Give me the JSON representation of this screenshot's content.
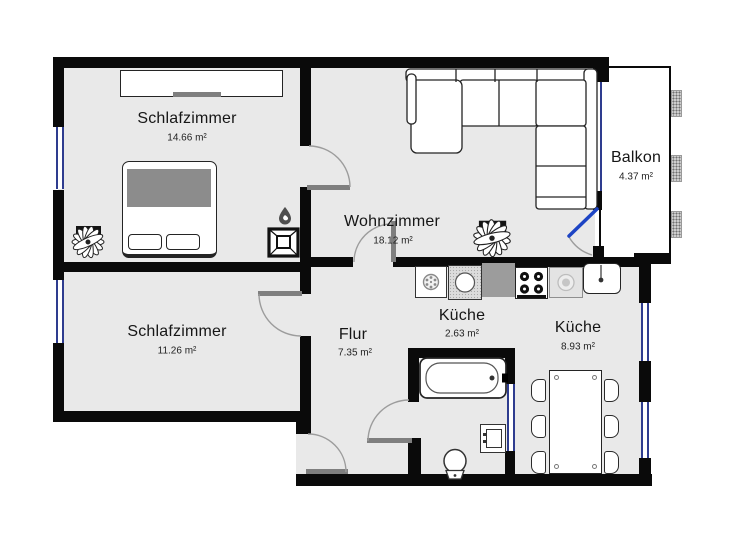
{
  "plan": {
    "title": "Wohnung Grundriss",
    "rooms": [
      {
        "name": "Schlafzimmer",
        "area": "14.66 m²"
      },
      {
        "name": "Wohnzimmer",
        "area": "18.12 m²"
      },
      {
        "name": "Balkon",
        "area": "4.37 m²"
      },
      {
        "name": "Schlafzimmer",
        "area": "11.26 m²"
      },
      {
        "name": "Flur",
        "area": "7.35 m²"
      },
      {
        "name": "Küche",
        "area": "2.63 m²"
      },
      {
        "name": "Küche",
        "area": "8.93 m²"
      }
    ],
    "colors": {
      "wall": "#0a0a0a",
      "floor": "#e9e9e9",
      "window_blue": "#2e3c8f",
      "balcony_door_blue": "#1d44c4",
      "door_frame_gray": "#7f7f7f"
    },
    "symbols": [
      "wardrobe",
      "double-bed",
      "plant",
      "flame",
      "chimney",
      "corner-sofa",
      "fridge",
      "washing-machine",
      "countertop",
      "stove",
      "dishwasher",
      "kitchen-sink",
      "bathtub",
      "toilet",
      "vanity-cabinet",
      "dining-table",
      "chair",
      "window",
      "door-arc"
    ]
  }
}
